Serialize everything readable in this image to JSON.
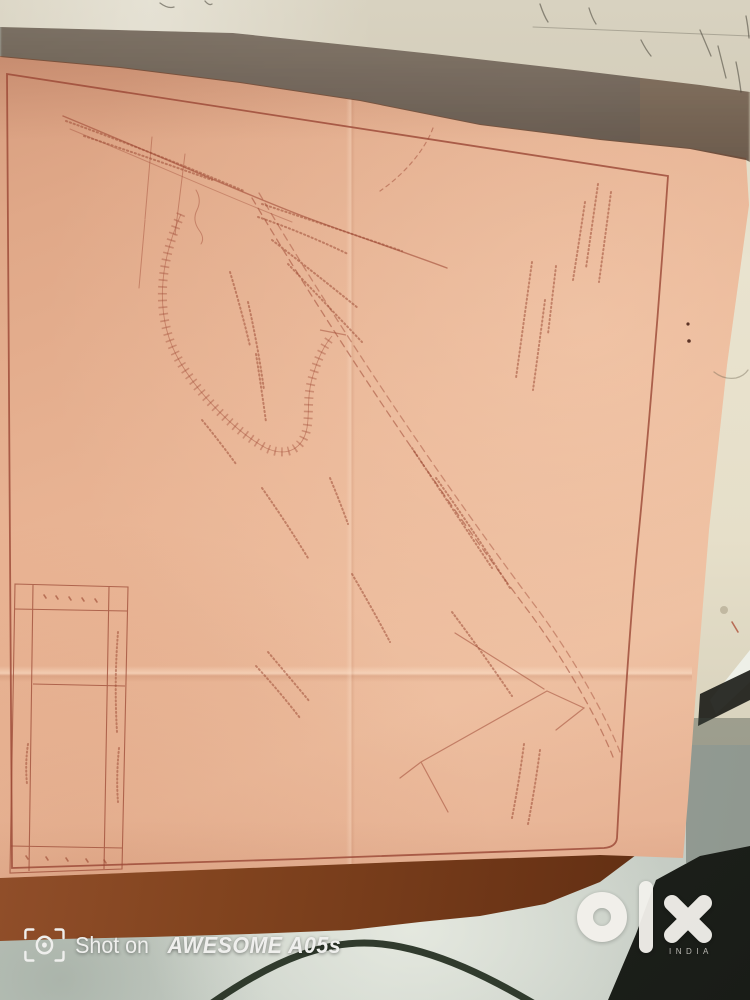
{
  "watermark": {
    "icon": "camera-viewfinder-icon",
    "shot_on": "Shot on",
    "device": "AWESOME A05s"
  },
  "brand": {
    "logo": "olx",
    "country": "INDIA"
  },
  "colors": {
    "paper_pink": "#e7b294",
    "map_ink": "#a04a36",
    "frame_ink": "#9a4634",
    "annotation_ink": "#99452f",
    "roll_paper": "#c9c0aa",
    "wall_cream": "#e9e3cf",
    "floor": "#c9d0c8",
    "table_edge_brown": "#7a3f1d",
    "dark_object": "#232723",
    "cable": "#222c1e",
    "watermark_white": "#efefed"
  }
}
